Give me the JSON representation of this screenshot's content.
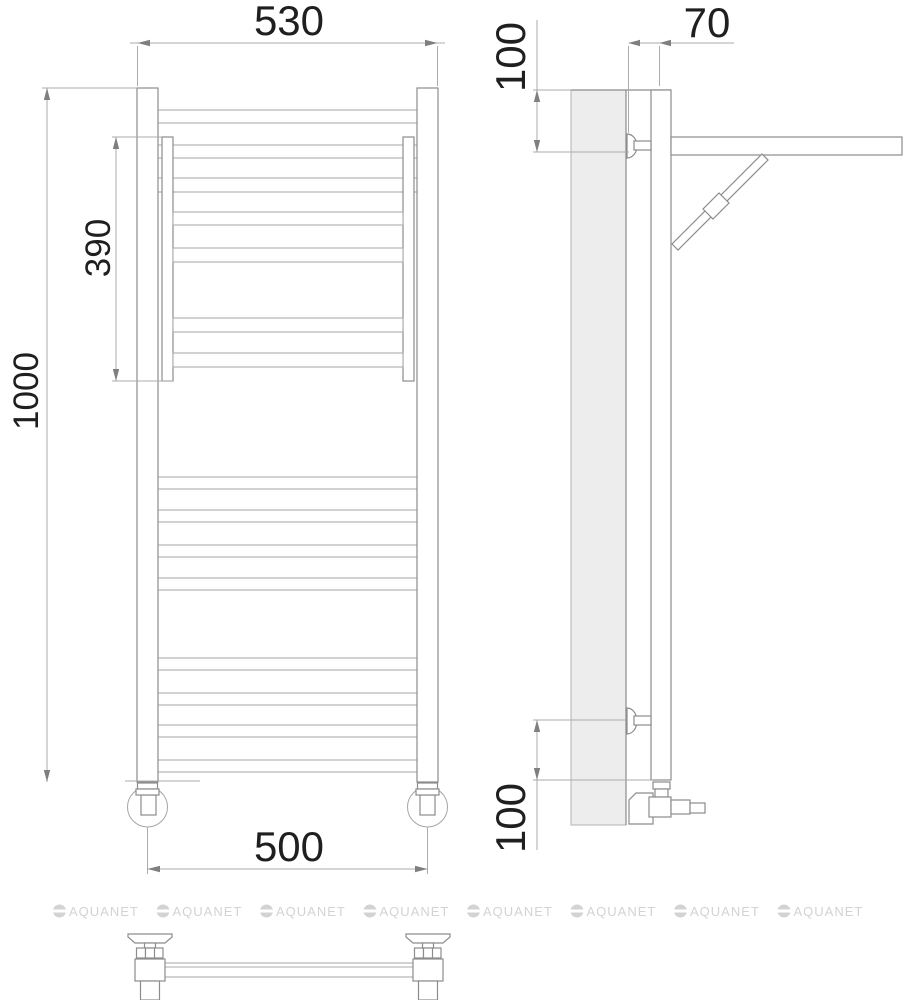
{
  "drawing": {
    "front_view": {
      "dim_top_width": "530",
      "dim_total_height": "1000",
      "dim_shelf_section_height": "390",
      "dim_bottom_width": "500"
    },
    "side_view": {
      "dim_wall_offset": "70",
      "dim_top_mount_offset": "100",
      "dim_bottom_mount_offset": "100"
    },
    "watermark": {
      "brand": "AQUANET"
    },
    "colors": {
      "object_line": "#8c8c8c",
      "rung_line": "#a6a6a6",
      "dimension_line": "#ababab",
      "dimension_text": "#1f1f1f",
      "wall_fill": "#ededed",
      "watermark": "#d3d3d3"
    }
  }
}
